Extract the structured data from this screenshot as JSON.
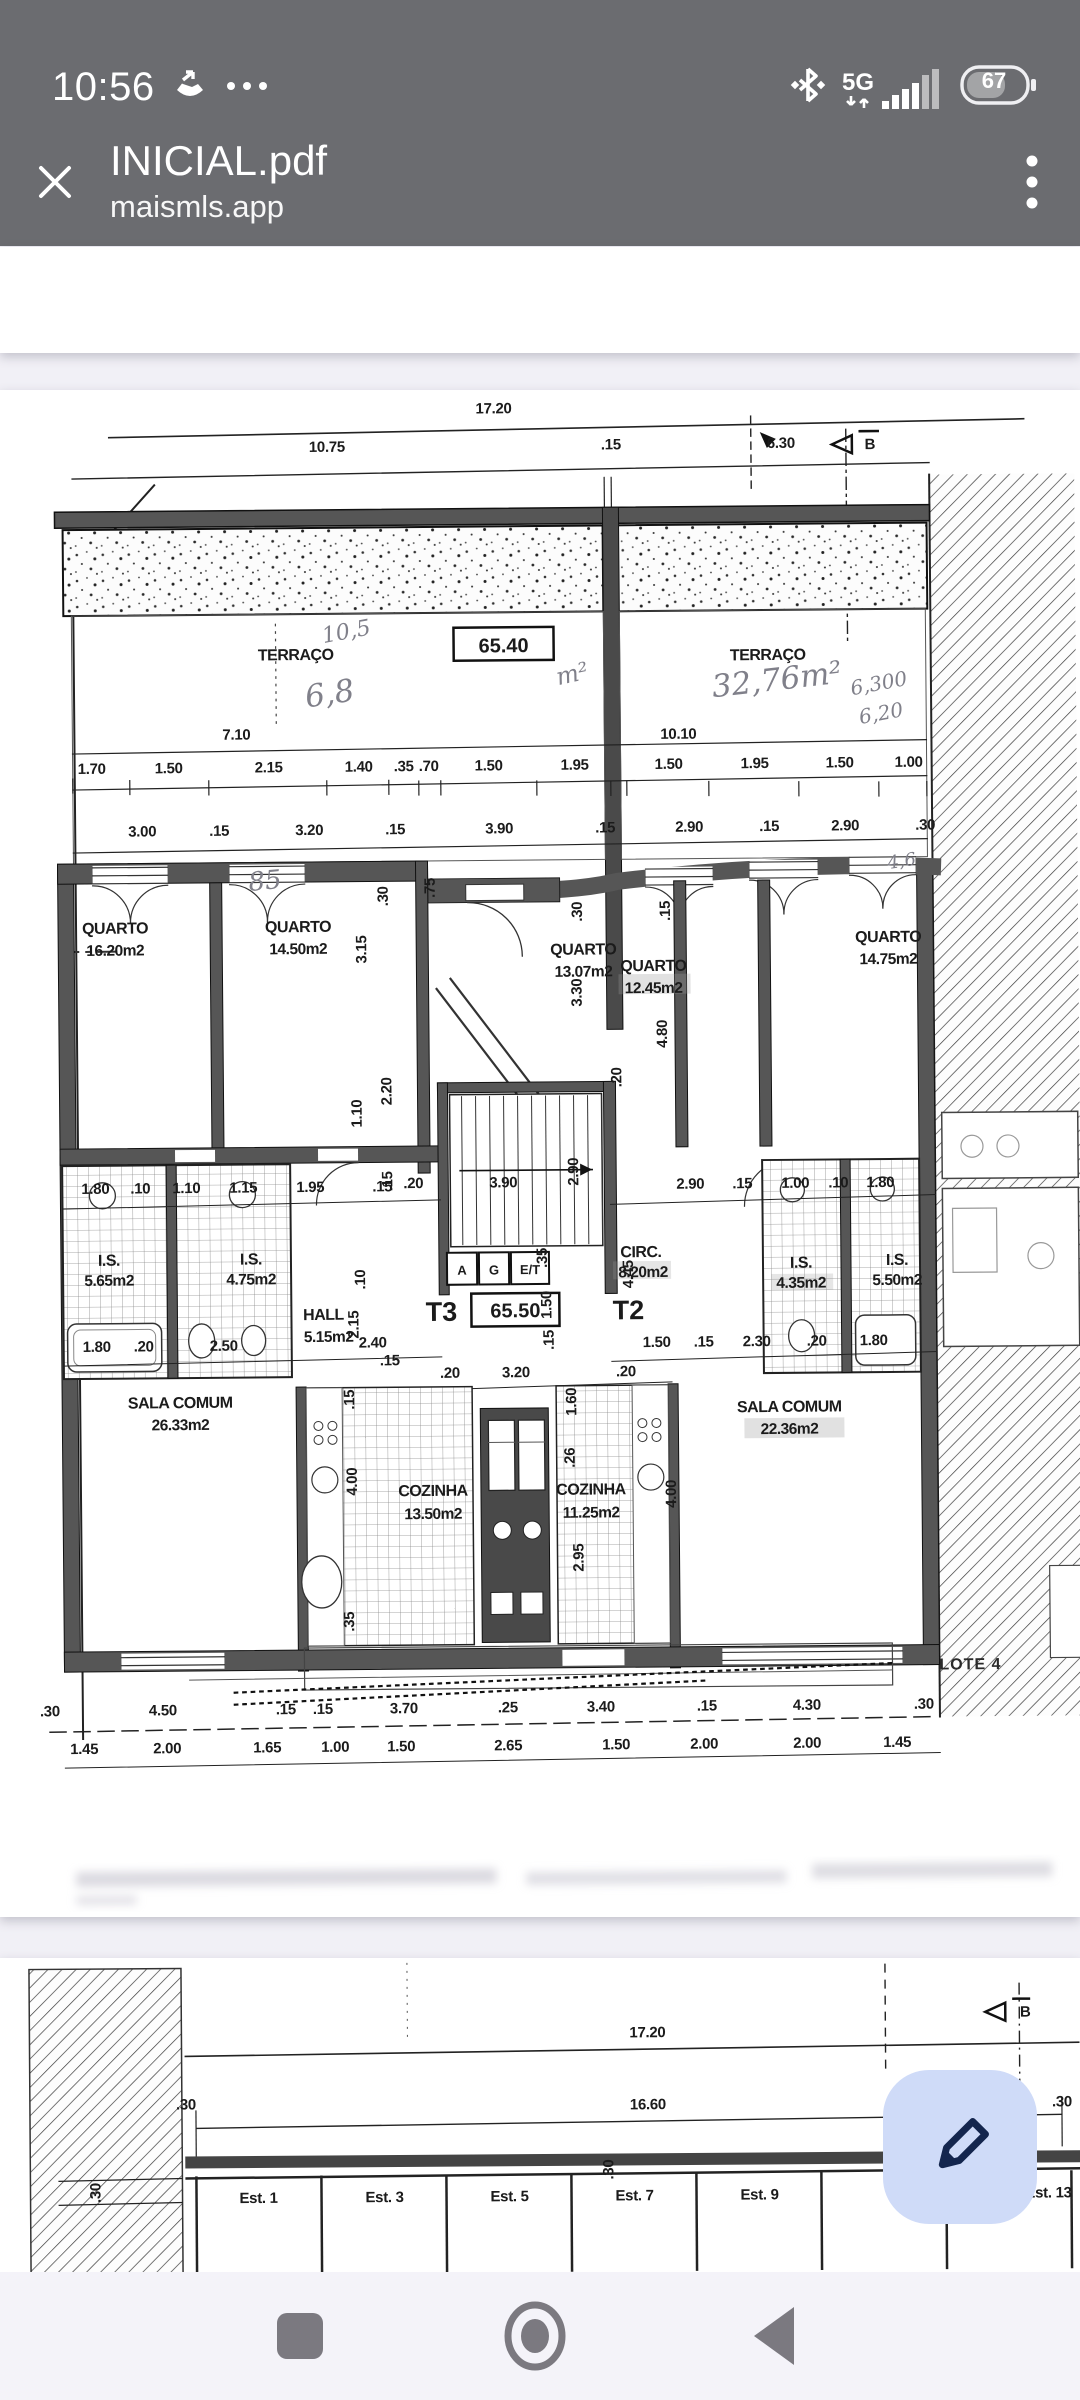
{
  "colors": {
    "app_bar": "#6b6c70",
    "viewer_bg": "#f1f0f6",
    "page_bg": "#ffffff",
    "nav_bg": "#f4f3f9",
    "nav_icon": "#7b7980",
    "fab_bg": "#cfdbf8",
    "fab_icon": "#14264e",
    "ink": "#1b1b1b",
    "pencil": "#80808a"
  },
  "status_bar": {
    "time": "10:56",
    "network_label": "5G",
    "battery_level": "67"
  },
  "header": {
    "title": "INICIAL.pdf",
    "subtitle": "maismls.app"
  },
  "icons": {
    "status_left": [
      "call-forward-icon",
      "more-notifications-icon"
    ],
    "status_right": [
      "bluetooth-icon",
      "signal-5g-icon",
      "battery-icon"
    ],
    "header": [
      "close-icon",
      "overflow-menu-icon"
    ],
    "fab": "pencil-icon",
    "nav": [
      "recent-apps-icon",
      "home-icon",
      "back-icon"
    ],
    "plan": "section-marker-icon"
  },
  "pdf": {
    "page1": {
      "top_dims": [
        "17.20",
        "10.75",
        ".15",
        "6.30"
      ],
      "section_marker": "B",
      "terrace_left": {
        "name": "TERRAÇO",
        "area_boxed": "65.40",
        "hand_units": "m²",
        "hand_note_1": "10,5",
        "hand_note_2": "6,8",
        "width_dim": "7.10"
      },
      "terrace_right": {
        "name": "TERRAÇO",
        "hand_area": "32,76m²",
        "hand_note_1": "6,300",
        "hand_note_2": "6,20",
        "width_dim": "10.10"
      },
      "dim_row_a": [
        "1.70",
        "1.50",
        "2.15",
        "1.40",
        ".35",
        ".70",
        "1.50",
        "1.95",
        "1.50",
        "1.95",
        "1.50",
        "1.00"
      ],
      "dim_row_b": [
        "3.00",
        ".15",
        "3.20",
        ".15",
        "3.90",
        ".15",
        "2.90",
        ".15",
        "2.90",
        ".30"
      ],
      "hand_row_note": "85",
      "hand_side_note": "4,6",
      "rooms": {
        "q1": {
          "name": "QUARTO",
          "area": "16.20m2"
        },
        "q2": {
          "name": "QUARTO",
          "area": "14.50m2"
        },
        "q3": {
          "name": "QUARTO",
          "area": "13.07m2"
        },
        "q4": {
          "name": "QUARTO",
          "area": "12.45m2"
        },
        "q5": {
          "name": "QUARTO",
          "area": "14.75m2"
        },
        "hall": {
          "name": "HALL",
          "area": "5.15m2"
        },
        "circ": {
          "name": "CIRC.",
          "area": "8.20m2"
        },
        "is1": {
          "name": "I.S.",
          "area": "5.65m2"
        },
        "is2": {
          "name": "I.S.",
          "area": "4.75m2"
        },
        "is3": {
          "name": "I.S.",
          "area": "4.35m2"
        },
        "is4": {
          "name": "I.S.",
          "area": "5.50m2"
        },
        "sala1": {
          "name": "SALA COMUM",
          "area": "26.33m2"
        },
        "sala2": {
          "name": "SALA COMUM",
          "area": "22.36m2"
        },
        "coz1": {
          "name": "COZINHA",
          "area": "13.50m2"
        },
        "coz2": {
          "name": "COZINHA",
          "area": "11.25m2"
        }
      },
      "unit_labels": {
        "t3": "T3",
        "area_boxed": "65.50",
        "t2": "T2"
      },
      "elevator_cells": [
        "A",
        "G",
        "E/T"
      ],
      "mid_dim_row_left": [
        "1.80",
        ".10",
        "1.10",
        "1.15",
        "1.95",
        ".15"
      ],
      "mid_dim_row_center": [
        ".20",
        "3.90"
      ],
      "mid_dim_row_right": [
        "2.90",
        ".15",
        "1.00",
        ".10",
        "1.80"
      ],
      "low_dim_row_left": [
        "1.80",
        ".20",
        "2.50"
      ],
      "low_dim_row_right": [
        "1.50",
        ".15",
        "2.30",
        ".20",
        "1.80"
      ],
      "misc_dims": [
        ".15",
        "2.40",
        ".20",
        "3.20",
        ".20"
      ],
      "v_dims": [
        ".75",
        ".30",
        "3.15",
        "3.30",
        "4.80",
        "2.20",
        ".15",
        ".20",
        "2.90",
        "1.10",
        ".10",
        "2.15",
        "4.45",
        "1.50",
        ".35",
        ".15",
        "1.60",
        ".15",
        "4.00",
        "4.00",
        "2.95",
        ".26",
        ".35",
        ".30",
        ".15"
      ],
      "bottom_dim_row_a": [
        ".30",
        "4.50",
        ".15",
        ".15",
        "3.70",
        ".25",
        "3.40",
        ".15",
        "4.30",
        ".30"
      ],
      "bottom_dim_row_b": [
        "1.45",
        "2.00",
        "1.65",
        "1.00",
        "1.50",
        "2.65",
        "1.50",
        "2.00",
        "2.00",
        "1.45"
      ],
      "lot_label": "LOTE 4"
    },
    "page2": {
      "dims": [
        "17.20",
        "16.60"
      ],
      "edge_dims": [
        ".30",
        ".30",
        ".30",
        ".30"
      ],
      "section_marker": "B",
      "stalls": [
        "Est. 1",
        "Est. 3",
        "Est. 5",
        "Est. 7",
        "Est. 9",
        "Est. 13"
      ]
    }
  }
}
